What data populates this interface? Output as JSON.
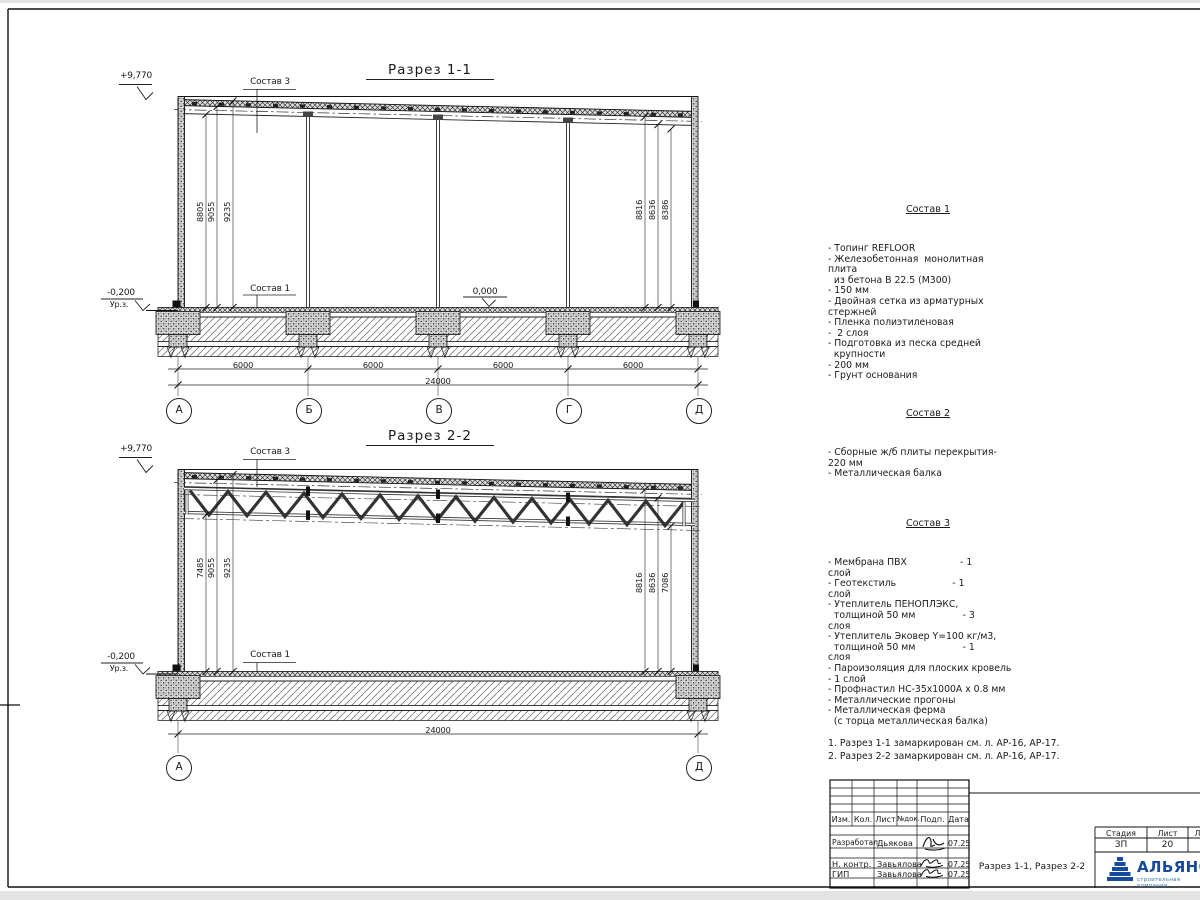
{
  "s1": {
    "title": "Разрез 1-1",
    "elev_top": "+9,770",
    "elev_zero": "0,000",
    "elev_ground": "-0,200",
    "ground": "Ур.з.",
    "sostav3": "Состав 3",
    "sostav1": "Состав 1",
    "dl": [
      "8805",
      "9055",
      "9235"
    ],
    "dr": [
      "8816",
      "8636",
      "8386"
    ],
    "db": [
      "6000",
      "6000",
      "6000",
      "6000"
    ],
    "total": "24000",
    "axes": [
      "А",
      "Б",
      "В",
      "Г",
      "Д"
    ]
  },
  "s2": {
    "title": "Разрез 2-2",
    "elev_top": "+9,770",
    "elev_ground": "-0,200",
    "ground": "Ур.з.",
    "sostav3": "Состав 3",
    "sostav1": "Состав 1",
    "dl": [
      "7485",
      "9055",
      "9235"
    ],
    "dr": [
      "8816",
      "8636",
      "7086"
    ],
    "total": "24000",
    "axes": [
      "А",
      "Д"
    ]
  },
  "sostav1": {
    "title": "Состав 1",
    "lines": [
      "- Топинг REFLOOR",
      "- Железобетонная  монолитная",
      "плита",
      "  из бетона В 22.5 (М300)",
      "- 150 мм",
      "- Двойная сетка из арматурных",
      "стержней",
      "- Пленка полиэтиленовая",
      "-  2 слоя",
      "- Подготовка из песка средней",
      "  крупности",
      "- 200 мм",
      "- Грунт основания"
    ]
  },
  "sostav2": {
    "title": "Состав 2",
    "lines": [
      "- Сборные ж/б плиты перекрытия-",
      "220 мм",
      "- Металлическая балка"
    ]
  },
  "sostav3": {
    "title": "Состав 3",
    "lines": [
      "- Мембрана ПВХ                  - 1",
      "слой",
      "- Геотекстиль                   - 1",
      "слой",
      "- Утеплитель ПЕНОПЛЭКС,",
      "  толщиной 50 мм                - 3",
      "слоя",
      "- Утеплитель Эковер Y=100 кг/м3,",
      "  толщиной 50 мм                - 1",
      "слоя",
      "- Пароизоляция для плоских кровель",
      "- 1 слой",
      "- Профнастил НС-35х1000А х 0.8 мм",
      "- Металлические прогоны",
      "- Металлическая ферма",
      "  (с торца металлическая балка)"
    ]
  },
  "notes": [
    "1. Разрез 1-1 замаркирован см. л. АР-16, АР-17.",
    "2. Разрез 2-2 замаркирован см. л. АР-16, АР-17."
  ],
  "tb": {
    "cols": [
      "Изм.",
      "Кол.",
      "Лист",
      "№док.",
      "Подп.",
      "Дата"
    ],
    "sign_rows": [
      {
        "role": "Разработал",
        "name": "Дьякова",
        "date": "07.25"
      },
      {
        "role": "Н. контр.",
        "name": "Завьялова",
        "date": "07.25"
      },
      {
        "role": "ГИП",
        "name": "Завьялова",
        "date": "07.25"
      }
    ],
    "doc_title": "Разрез 1-1, Разрез 2-2",
    "stage_h": "Стадия",
    "sheet_h": "Лист",
    "sheets_h": "Листов",
    "stage": "ЗП",
    "sheet": "20",
    "sheets": "21",
    "logo": "АЛЬЯНС",
    "logo_sub": "строительная компания",
    "logo_color": "#17499c"
  }
}
